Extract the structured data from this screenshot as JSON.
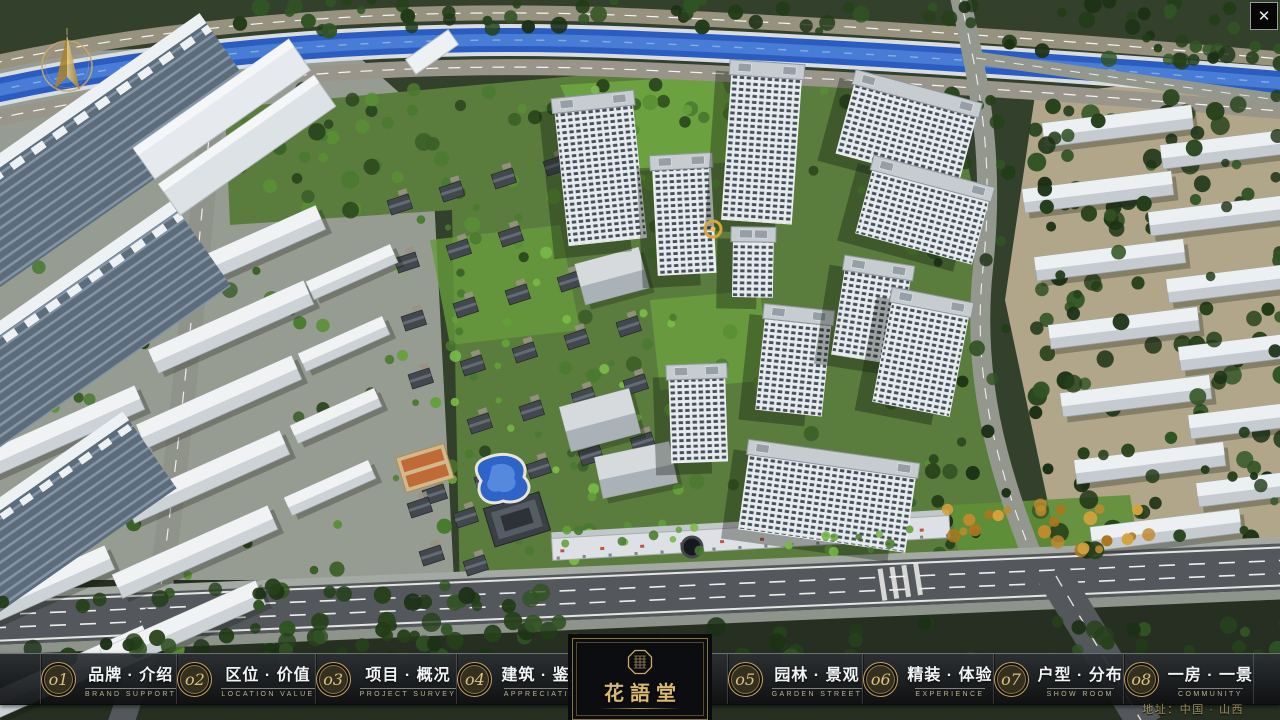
{
  "app": {
    "close_glyph": "✕"
  },
  "menu": {
    "items": [
      {
        "num": "o1",
        "zh": "品牌 · 介绍",
        "en": "BRAND SUPPORT"
      },
      {
        "num": "o2",
        "zh": "区位 · 价值",
        "en": "LOCATION VALUE"
      },
      {
        "num": "o3",
        "zh": "项目 · 概况",
        "en": "PROJECT SURVEY"
      },
      {
        "num": "o4",
        "zh": "建筑 · 鉴赏",
        "en": "APPRECIATION"
      },
      {
        "num": "o5",
        "zh": "园林 · 景观",
        "en": "GARDEN STREET"
      },
      {
        "num": "o6",
        "zh": "精装 · 体验",
        "en": "EXPERIENCE"
      },
      {
        "num": "o7",
        "zh": "户型 · 分布",
        "en": "SHOW ROOM"
      },
      {
        "num": "o8",
        "zh": "一房 · 一景",
        "en": "COMMUNITY"
      }
    ]
  },
  "logo": {
    "title": "花語堂"
  },
  "footer": {
    "address": "地址：中国 · 山西"
  },
  "colors": {
    "gold": "#c9a96a",
    "river": "#2b5cc2",
    "bar_bg": "#0d0f11"
  }
}
